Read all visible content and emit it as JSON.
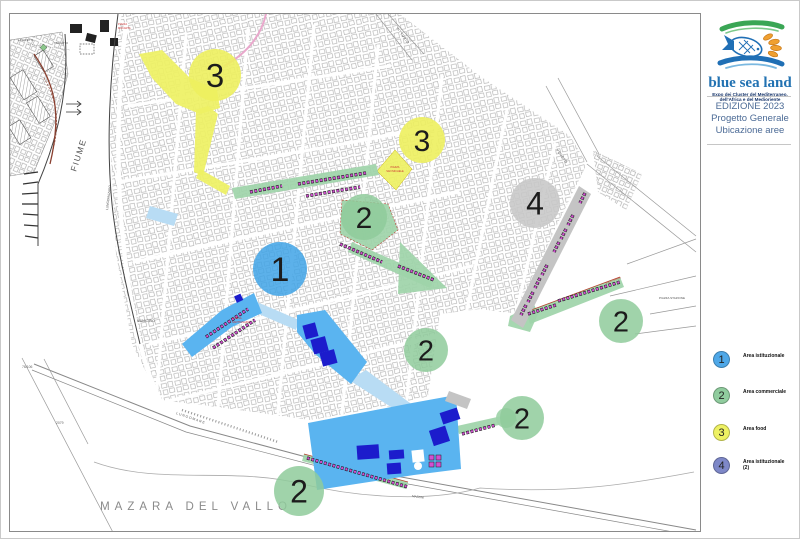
{
  "sidebar": {
    "logo": {
      "title": "blue sea land",
      "subtitle_line1": "Expo dei Cluster del Mediterraneo,",
      "subtitle_line2": "dell'Africa e del Medioriente"
    },
    "edition": {
      "line1": "EDIZIONE 2023",
      "line2": "Progetto Generale",
      "line3": "Ubicazione aree"
    },
    "legend": [
      {
        "number": "1",
        "label": "Area istituzionale",
        "suffix": "",
        "color": "#4fa8e8"
      },
      {
        "number": "2",
        "label": "Area commerciale",
        "suffix": "",
        "color": "#90cc9e"
      },
      {
        "number": "3",
        "label": "Area food",
        "suffix": "",
        "color": "#eef163"
      },
      {
        "number": "4",
        "label": "Area istituzionale",
        "suffix": "(2)",
        "color": "#7e88c8"
      }
    ]
  },
  "map": {
    "city_label": "MAZARA  DEL  VALLO",
    "labels": {
      "fiume": "FIUME",
      "lungomazaro": "LUNGOMAZARO",
      "municipio": "MUNICIPIO",
      "la_civetta": "LA CIVETTA",
      "tragitto": "TRAGITTO",
      "piazza_stazione": "PIAZZA STAZIONE",
      "vittorio": "VITTORIO",
      "veneto": "VENETO",
      "lungomare": "LUNGOMARE",
      "mazzini": "MAZZINI",
      "piazza_sm_1": "PIAZZA",
      "piazza_sm_2": "SAN MICHELE",
      "chiesa_1": "CHIESA",
      "chiesa_2": "SANT'IGNAZIO",
      "mokarta_1": "PIAZZA",
      "mokarta_2": "MOKARTA",
      "via_crispi": "VIA F. CRISPI",
      "num_a": "76/106",
      "num_b": "2079"
    },
    "markers": [
      {
        "number": "1",
        "color": "#3fa3e6"
      },
      {
        "number": "2",
        "color": "#8fcb9b"
      },
      {
        "number": "2",
        "color": "#8fcb9b"
      },
      {
        "number": "2",
        "color": "#8fcb9b"
      },
      {
        "number": "2",
        "color": "#8fcb9b"
      },
      {
        "number": "2",
        "color": "#8fcb9b"
      },
      {
        "number": "3",
        "color": "#edef5e"
      },
      {
        "number": "3",
        "color": "#edef5e"
      },
      {
        "number": "4",
        "color": "#c7c7c7"
      }
    ]
  }
}
